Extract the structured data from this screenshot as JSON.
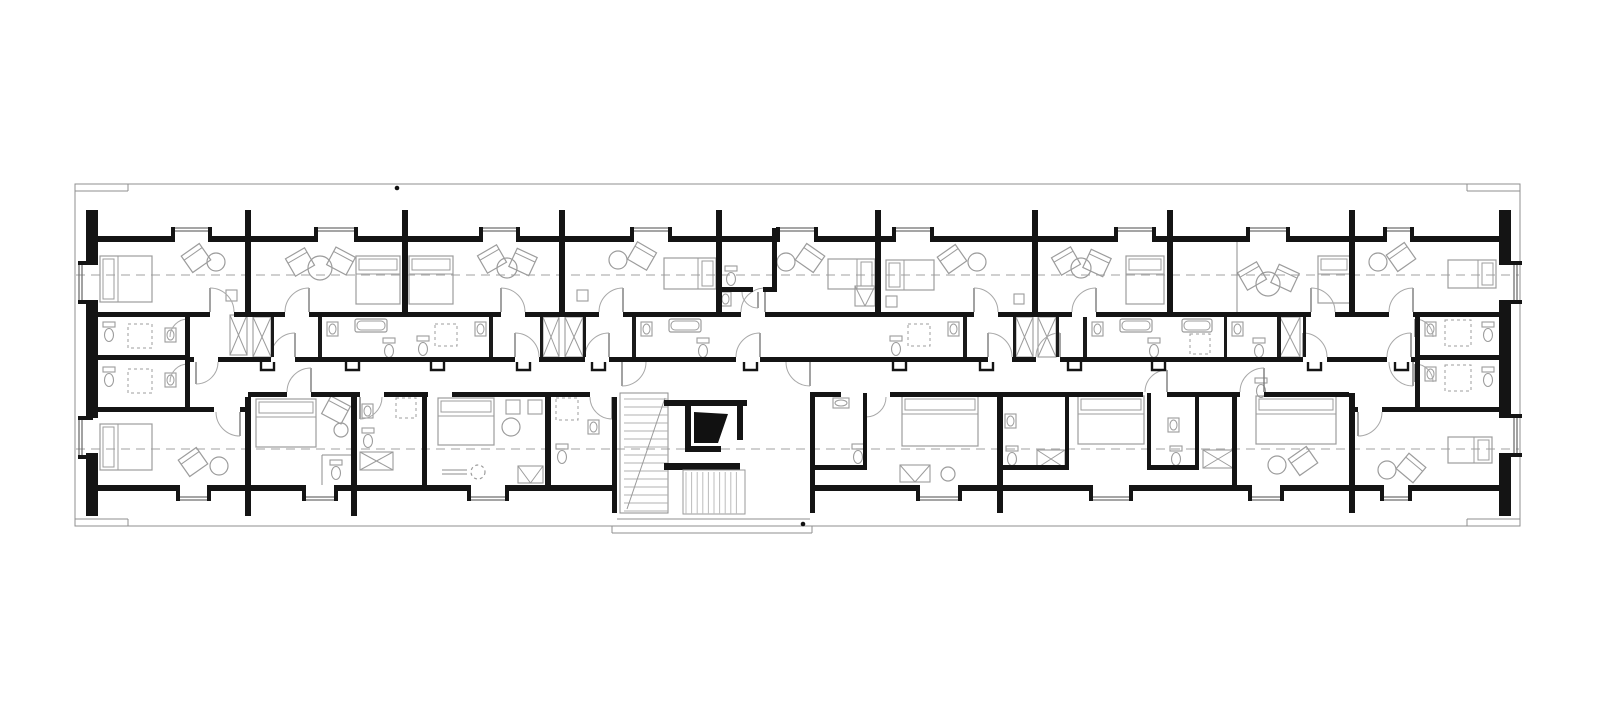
{
  "canvas": {
    "w": 1600,
    "h": 728
  },
  "colors": {
    "wall": "#141414",
    "thinwall": "#1a1a1a",
    "site": "#8f8f8f",
    "axis": "#b5b5b5",
    "furniture": "#9c9c9c",
    "glazing": "#6f6f6f",
    "door": "#a8a8a8",
    "leaf": "#7a7a7a",
    "hatch": "#bcbcbc",
    "tread": "#b0b0b0",
    "background": "#ffffff"
  },
  "site": {
    "outer": [
      75,
      184,
      1445,
      342
    ],
    "steps": [
      [
        75,
        191,
        128,
        191
      ],
      [
        1467,
        191,
        1520,
        191
      ],
      [
        75,
        519,
        128,
        519
      ],
      [
        1467,
        519,
        1520,
        519
      ],
      [
        128,
        184,
        128,
        191
      ],
      [
        1467,
        184,
        1467,
        191
      ],
      [
        128,
        519,
        128,
        526
      ],
      [
        1467,
        519,
        1467,
        526
      ],
      [
        612,
        526,
        612,
        533
      ],
      [
        612,
        533,
        812,
        533
      ],
      [
        812,
        526,
        812,
        533
      ],
      [
        617,
        519,
        810,
        519
      ]
    ],
    "dots": [
      [
        397,
        188
      ],
      [
        803,
        524
      ]
    ]
  },
  "axes": [
    [
      76,
      275,
      1519,
      275
    ],
    [
      76,
      449,
      1519,
      449
    ]
  ],
  "walls_black": [
    [
      86,
      210,
      12,
      55
    ],
    [
      86,
      300,
      12,
      118
    ],
    [
      86,
      453,
      12,
      63
    ],
    [
      1499,
      210,
      12,
      55
    ],
    [
      1499,
      300,
      12,
      118
    ],
    [
      1499,
      453,
      12,
      63
    ],
    [
      245,
      210,
      6,
      107
    ],
    [
      402,
      210,
      6,
      107
    ],
    [
      559,
      210,
      6,
      107
    ],
    [
      716,
      210,
      6,
      107
    ],
    [
      875,
      210,
      6,
      107
    ],
    [
      1032,
      210,
      6,
      107
    ],
    [
      1167,
      210,
      6,
      107
    ],
    [
      1349,
      210,
      6,
      107
    ],
    [
      772,
      228,
      5,
      64
    ],
    [
      719,
      287,
      34,
      5
    ],
    [
      763,
      287,
      9,
      5
    ],
    [
      98,
      236,
      77,
      6
    ],
    [
      208,
      236,
      110,
      6
    ],
    [
      354,
      236,
      129,
      6
    ],
    [
      516,
      236,
      118,
      6
    ],
    [
      668,
      236,
      112,
      6
    ],
    [
      814,
      236,
      82,
      6
    ],
    [
      930,
      236,
      188,
      6
    ],
    [
      1152,
      236,
      98,
      6
    ],
    [
      1286,
      236,
      101,
      6
    ],
    [
      1410,
      236,
      89,
      6
    ],
    [
      86,
      312,
      124,
      5
    ],
    [
      234,
      312,
      51,
      5
    ],
    [
      309,
      312,
      192,
      5
    ],
    [
      525,
      312,
      74,
      5
    ],
    [
      623,
      312,
      118,
      5
    ],
    [
      765,
      312,
      209,
      5
    ],
    [
      998,
      312,
      74,
      5
    ],
    [
      1096,
      312,
      215,
      5
    ],
    [
      1335,
      312,
      54,
      5
    ],
    [
      1413,
      312,
      98,
      5
    ],
    [
      190,
      357,
      4,
      5
    ],
    [
      218,
      357,
      53,
      5
    ],
    [
      295,
      357,
      220,
      5
    ],
    [
      539,
      357,
      46,
      5
    ],
    [
      609,
      357,
      127,
      5
    ],
    [
      760,
      357,
      228,
      5
    ],
    [
      1012,
      357,
      24,
      5
    ],
    [
      1060,
      357,
      243,
      5
    ],
    [
      1327,
      357,
      60,
      5
    ],
    [
      1411,
      357,
      4,
      5
    ],
    [
      186,
      357,
      4,
      40
    ],
    [
      248,
      392,
      39,
      5
    ],
    [
      311,
      392,
      49,
      5
    ],
    [
      384,
      392,
      44,
      5
    ],
    [
      452,
      392,
      138,
      5
    ],
    [
      815,
      392,
      26,
      5
    ],
    [
      890,
      392,
      253,
      5
    ],
    [
      1167,
      392,
      73,
      5
    ],
    [
      1264,
      392,
      85,
      5
    ],
    [
      185,
      317,
      5,
      90
    ],
    [
      98,
      355,
      87,
      5
    ],
    [
      98,
      407,
      92,
      5
    ],
    [
      190,
      407,
      24,
      5
    ],
    [
      240,
      407,
      8,
      5
    ],
    [
      1415,
      317,
      5,
      90
    ],
    [
      1420,
      355,
      79,
      5
    ],
    [
      1415,
      407,
      84,
      5
    ],
    [
      1349,
      407,
      9,
      5
    ],
    [
      1382,
      407,
      33,
      5
    ],
    [
      245,
      397,
      6,
      119
    ],
    [
      351,
      393,
      6,
      123
    ],
    [
      422,
      393,
      5,
      92
    ],
    [
      545,
      393,
      6,
      92
    ],
    [
      612,
      397,
      5,
      116
    ],
    [
      810,
      392,
      5,
      121
    ],
    [
      863,
      393,
      4,
      77
    ],
    [
      997,
      393,
      6,
      120
    ],
    [
      1065,
      393,
      4,
      77
    ],
    [
      1147,
      393,
      4,
      77
    ],
    [
      1195,
      393,
      4,
      77
    ],
    [
      1232,
      393,
      5,
      92
    ],
    [
      1349,
      393,
      6,
      120
    ],
    [
      815,
      465,
      52,
      5
    ],
    [
      997,
      465,
      72,
      5
    ],
    [
      1147,
      465,
      52,
      5
    ],
    [
      98,
      485,
      82,
      6
    ],
    [
      207,
      485,
      99,
      6
    ],
    [
      334,
      485,
      137,
      6
    ],
    [
      505,
      485,
      107,
      6
    ],
    [
      815,
      485,
      105,
      6
    ],
    [
      958,
      485,
      135,
      6
    ],
    [
      1129,
      485,
      123,
      6
    ],
    [
      1280,
      485,
      104,
      6
    ],
    [
      1408,
      485,
      91,
      6
    ]
  ],
  "walls_thin": [
    [
      318,
      317,
      4,
      40
    ],
    [
      271,
      317,
      3,
      40
    ],
    [
      489,
      317,
      4,
      40
    ],
    [
      540,
      317,
      3,
      40
    ],
    [
      632,
      317,
      4,
      40
    ],
    [
      583,
      317,
      3,
      40
    ],
    [
      963,
      317,
      4,
      40
    ],
    [
      1013,
      317,
      3,
      40
    ],
    [
      1083,
      317,
      4,
      40
    ],
    [
      1056,
      317,
      3,
      40
    ],
    [
      1224,
      317,
      3,
      40
    ],
    [
      1277,
      317,
      4,
      40
    ],
    [
      1303,
      317,
      3,
      40
    ]
  ],
  "thin_lines": [
    [
      322,
      455,
      322,
      485
    ],
    [
      322,
      455,
      357,
      455
    ],
    [
      442,
      470,
      467,
      470
    ],
    [
      442,
      474,
      467,
      474
    ],
    [
      1237,
      242,
      1237,
      312
    ]
  ],
  "windows_top": [
    [
      175,
      208
    ],
    [
      318,
      354
    ],
    [
      483,
      516
    ],
    [
      634,
      668
    ],
    [
      780,
      814
    ],
    [
      896,
      930
    ],
    [
      1118,
      1152
    ],
    [
      1250,
      1286
    ],
    [
      1387,
      1410
    ]
  ],
  "windows_bottom": [
    [
      180,
      207
    ],
    [
      306,
      334
    ],
    [
      471,
      505
    ],
    [
      920,
      958
    ],
    [
      1093,
      1129
    ],
    [
      1252,
      1280
    ],
    [
      1384,
      1408
    ]
  ],
  "windows_left": [
    [
      265,
      300
    ],
    [
      420,
      455
    ]
  ],
  "windows_right": [
    [
      265,
      300
    ],
    [
      418,
      453
    ]
  ],
  "doors": [
    [
      196,
      362,
      22,
      "se"
    ],
    [
      240,
      412,
      24,
      "sw"
    ],
    [
      309,
      312,
      24,
      "nw"
    ],
    [
      501,
      312,
      24,
      "ne"
    ],
    [
      623,
      312,
      24,
      "nw"
    ],
    [
      765,
      312,
      24,
      "nw"
    ],
    [
      974,
      312,
      24,
      "ne"
    ],
    [
      1096,
      312,
      24,
      "nw"
    ],
    [
      1311,
      312,
      24,
      "ne"
    ],
    [
      1413,
      312,
      24,
      "nw"
    ],
    [
      210,
      312,
      24,
      "ne"
    ],
    [
      295,
      357,
      24,
      "nw"
    ],
    [
      515,
      357,
      24,
      "ne"
    ],
    [
      609,
      357,
      24,
      "nw"
    ],
    [
      760,
      357,
      24,
      "nw"
    ],
    [
      988,
      357,
      24,
      "ne"
    ],
    [
      1060,
      357,
      24,
      "nw"
    ],
    [
      1303,
      357,
      24,
      "ne"
    ],
    [
      1411,
      357,
      24,
      "nw"
    ],
    [
      188,
      337,
      18,
      "nw"
    ],
    [
      188,
      382,
      18,
      "nw"
    ],
    [
      1415,
      337,
      18,
      "ne"
    ],
    [
      1415,
      382,
      18,
      "ne"
    ],
    [
      311,
      392,
      24,
      "nw"
    ],
    [
      360,
      397,
      22,
      "se"
    ],
    [
      866,
      397,
      20,
      "se"
    ],
    [
      1167,
      392,
      22,
      "nw"
    ],
    [
      1264,
      392,
      24,
      "nw"
    ],
    [
      1358,
      412,
      24,
      "se"
    ],
    [
      612,
      397,
      22,
      "sw"
    ],
    [
      622,
      362,
      24,
      "se"
    ],
    [
      810,
      362,
      24,
      "sw"
    ],
    [
      1413,
      362,
      24,
      "sw"
    ],
    [
      758,
      292,
      16,
      "sw"
    ]
  ],
  "stubs": {
    "y": 362,
    "h": 8,
    "w": 13,
    "x": [
      261,
      346,
      431,
      517,
      592,
      744,
      893,
      980,
      1068,
      1152,
      1308,
      1395
    ]
  },
  "furniture": {
    "beds": [
      [
        100,
        256,
        52,
        46,
        "left"
      ],
      [
        356,
        256,
        44,
        48,
        "top"
      ],
      [
        409,
        256,
        44,
        48,
        "top"
      ],
      [
        664,
        258,
        52,
        31,
        "right"
      ],
      [
        828,
        259,
        47,
        30,
        "right"
      ],
      [
        886,
        260,
        48,
        30,
        "left"
      ],
      [
        1126,
        256,
        38,
        48,
        "top"
      ],
      [
        1318,
        256,
        32,
        47,
        "top"
      ],
      [
        1448,
        260,
        48,
        28,
        "right"
      ],
      [
        100,
        424,
        52,
        46,
        "left"
      ],
      [
        256,
        399,
        60,
        48,
        "top"
      ],
      [
        438,
        398,
        56,
        47,
        "top"
      ],
      [
        902,
        396,
        76,
        50,
        "top"
      ],
      [
        1078,
        396,
        66,
        48,
        "top"
      ],
      [
        1256,
        396,
        80,
        48,
        "top"
      ],
      [
        1448,
        437,
        44,
        26,
        "right"
      ]
    ],
    "chairs": [
      [
        196,
        258,
        -35
      ],
      [
        300,
        262,
        -30
      ],
      [
        341,
        261,
        28
      ],
      [
        492,
        259,
        -30
      ],
      [
        523,
        262,
        25
      ],
      [
        642,
        256,
        30
      ],
      [
        810,
        258,
        35
      ],
      [
        952,
        259,
        -35
      ],
      [
        1066,
        261,
        -30
      ],
      [
        1097,
        263,
        25
      ],
      [
        1252,
        276,
        -30
      ],
      [
        1285,
        278,
        25
      ],
      [
        1401,
        257,
        -35
      ],
      [
        193,
        462,
        -35
      ],
      [
        336,
        410,
        28
      ],
      [
        1303,
        461,
        -35
      ],
      [
        1411,
        468,
        40
      ]
    ],
    "tables": [
      [
        216,
        262,
        9,
        0
      ],
      [
        320,
        268,
        12,
        0
      ],
      [
        507,
        268,
        10,
        0
      ],
      [
        618,
        260,
        9,
        0
      ],
      [
        786,
        262,
        9,
        0
      ],
      [
        977,
        262,
        9,
        0
      ],
      [
        1081,
        268,
        10,
        0
      ],
      [
        1268,
        284,
        12,
        0
      ],
      [
        1378,
        262,
        9,
        0
      ],
      [
        219,
        466,
        9,
        0
      ],
      [
        341,
        430,
        7,
        0
      ],
      [
        511,
        427,
        9,
        0
      ],
      [
        948,
        474,
        7,
        0
      ],
      [
        1277,
        465,
        9,
        0
      ],
      [
        1387,
        470,
        9,
        0
      ],
      [
        478,
        472,
        7,
        1
      ]
    ],
    "squares": [
      [
        226,
        290,
        11
      ],
      [
        577,
        290,
        11
      ],
      [
        886,
        296,
        11
      ],
      [
        1014,
        294,
        10
      ],
      [
        506,
        400,
        14
      ],
      [
        528,
        400,
        14
      ]
    ],
    "toilets": [
      [
        103,
        322
      ],
      [
        103,
        367
      ],
      [
        725,
        266
      ],
      [
        330,
        460
      ],
      [
        362,
        428
      ],
      [
        556,
        444
      ],
      [
        852,
        444
      ],
      [
        1006,
        446
      ],
      [
        1170,
        446
      ],
      [
        1482,
        322
      ],
      [
        1482,
        367
      ],
      [
        417,
        336
      ],
      [
        890,
        336
      ],
      [
        383,
        338
      ],
      [
        697,
        338
      ],
      [
        1148,
        338
      ],
      [
        1253,
        338
      ],
      [
        1255,
        378
      ]
    ],
    "sinks": [
      [
        720,
        292,
        0
      ],
      [
        362,
        404,
        0
      ],
      [
        588,
        420,
        0
      ],
      [
        833,
        398,
        1
      ],
      [
        1005,
        414,
        0
      ],
      [
        1168,
        418,
        0
      ],
      [
        165,
        328,
        0
      ],
      [
        165,
        373,
        0
      ],
      [
        475,
        322,
        0
      ],
      [
        948,
        322,
        0
      ],
      [
        327,
        322,
        0
      ],
      [
        641,
        322,
        0
      ],
      [
        1092,
        322,
        0
      ],
      [
        1232,
        322,
        0
      ],
      [
        1425,
        322,
        0
      ],
      [
        1425,
        367,
        0
      ]
    ],
    "tubs": [
      [
        355,
        319,
        32,
        13
      ],
      [
        669,
        319,
        32,
        13
      ],
      [
        1120,
        319,
        32,
        13
      ],
      [
        1182,
        319,
        30,
        13
      ]
    ],
    "showers": [
      [
        128,
        324,
        24
      ],
      [
        128,
        369,
        24
      ],
      [
        435,
        324,
        22
      ],
      [
        908,
        324,
        22
      ],
      [
        1190,
        334,
        20
      ],
      [
        1445,
        320,
        26
      ],
      [
        1445,
        365,
        26
      ],
      [
        396,
        398,
        20
      ],
      [
        556,
        398,
        22
      ]
    ],
    "closets": [
      [
        230,
        315,
        17,
        40
      ],
      [
        253,
        317,
        18,
        40
      ],
      [
        543,
        317,
        16,
        40
      ],
      [
        565,
        317,
        18,
        40
      ],
      [
        1016,
        317,
        17,
        40
      ],
      [
        1038,
        317,
        18,
        40
      ],
      [
        1280,
        317,
        20,
        40
      ],
      [
        360,
        452,
        33,
        18
      ],
      [
        1037,
        450,
        28,
        18
      ],
      [
        1203,
        450,
        30,
        18
      ]
    ],
    "vracks": [
      [
        855,
        286,
        20,
        20
      ],
      [
        518,
        466,
        25,
        17
      ],
      [
        900,
        465,
        30,
        17
      ]
    ]
  },
  "core": {
    "stair": {
      "box": [
        620,
        393,
        48,
        120
      ],
      "tread_x1": 624,
      "tread_x2": 668,
      "tread_y1": 399,
      "tread_y2": 511,
      "step": 8,
      "diag": [
        627,
        509,
        665,
        398
      ]
    },
    "elevator": {
      "bars": [
        [
          664,
          400,
          83,
          6
        ],
        [
          685,
          406,
          6,
          46
        ],
        [
          737,
          406,
          6,
          34
        ],
        [
          685,
          446,
          36,
          6
        ],
        [
          664,
          463,
          76,
          7
        ]
      ],
      "wedge": [
        [
          694,
          412
        ],
        [
          728,
          414
        ],
        [
          718,
          443
        ],
        [
          694,
          443
        ]
      ]
    },
    "hatch": {
      "x1": 686,
      "x2": 742,
      "y1": 472,
      "y2": 514,
      "step": 5.6,
      "frame": [
        683,
        470,
        62,
        44
      ]
    }
  }
}
